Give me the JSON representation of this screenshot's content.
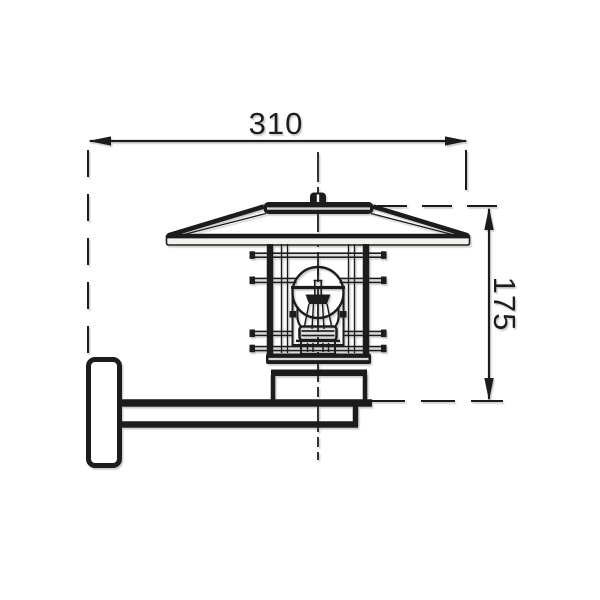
{
  "page": {
    "background": "#ffffff"
  },
  "drawing": {
    "subject": "wall-lantern-side-elevation",
    "line_color": "#1d1d1b",
    "shade_color": "#d6d6d3",
    "rim_fill": "#f1f1ee",
    "dimensions": {
      "width": {
        "label": "310",
        "orientation": "horizontal"
      },
      "height": {
        "label": "175",
        "orientation": "vertical"
      }
    }
  }
}
